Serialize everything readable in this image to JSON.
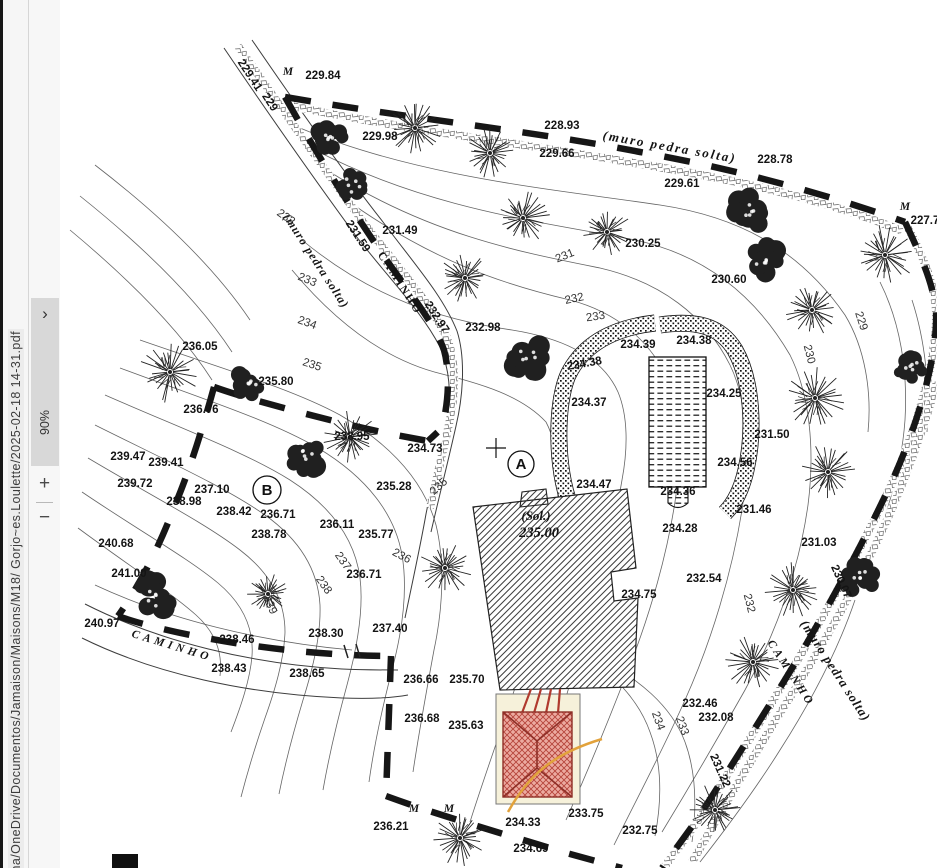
{
  "sidebar": {
    "file_path": "ma/OneDrive/Documentos/Jamaison/Maisons/M18/ Gorjo~es.Loulette/2025-02-18 14-31.pdf",
    "expand_chevron": "›",
    "zoom_level": "90%",
    "zoom_in": "+",
    "zoom_out": "−"
  },
  "map": {
    "site_label": "(Sol.)",
    "site_elevation": "235.00",
    "markers": [
      {
        "label": "A",
        "x": 521,
        "y": 464,
        "r": 13
      },
      {
        "label": "B",
        "x": 267,
        "y": 490,
        "r": 14
      }
    ],
    "labels": [
      {
        "t": "229.41",
        "x": 247,
        "y": 77,
        "r": 57
      },
      {
        "t": "229",
        "x": 267,
        "y": 104,
        "r": 57
      },
      {
        "t": "M",
        "x": 288,
        "y": 75,
        "i": 1,
        "f": "serif"
      },
      {
        "t": "229.84",
        "x": 323,
        "y": 79
      },
      {
        "t": "229.98",
        "x": 380,
        "y": 140
      },
      {
        "t": "228.93",
        "x": 562,
        "y": 129
      },
      {
        "t": "(muro pedra solta)",
        "x": 669,
        "y": 151,
        "r": 10,
        "i": 1,
        "f": "serif",
        "s": 13,
        "sp": 2
      },
      {
        "t": "229.66",
        "x": 557,
        "y": 157
      },
      {
        "t": "229.61",
        "x": 682,
        "y": 187
      },
      {
        "t": "228.78",
        "x": 775,
        "y": 163
      },
      {
        "t": "M",
        "x": 905,
        "y": 210,
        "i": 1,
        "f": "serif"
      },
      {
        "t": "227.7",
        "x": 925,
        "y": 224
      },
      {
        "t": "231.49",
        "x": 400,
        "y": 234
      },
      {
        "t": "230.25",
        "x": 643,
        "y": 247
      },
      {
        "t": "231",
        "x": 566,
        "y": 259,
        "r": -22,
        "c": "#333",
        "w": 400
      },
      {
        "t": "230.60",
        "x": 729,
        "y": 283
      },
      {
        "t": "229",
        "x": 858,
        "y": 322,
        "r": 72,
        "c": "#333",
        "w": 400
      },
      {
        "t": "230",
        "x": 806,
        "y": 355,
        "r": 76,
        "c": "#333",
        "w": 400
      },
      {
        "t": "(muro pedra solta)",
        "x": 313,
        "y": 263,
        "r": 57,
        "i": 1,
        "f": "serif",
        "s": 12,
        "sp": 1
      },
      {
        "t": "231.59",
        "x": 355,
        "y": 238,
        "r": 57
      },
      {
        "t": "CAMINHO",
        "x": 397,
        "y": 285,
        "r": 57,
        "f": "serif",
        "sp": 2
      },
      {
        "t": "232.97",
        "x": 434,
        "y": 319,
        "r": 57
      },
      {
        "t": "232",
        "x": 284,
        "y": 220,
        "r": 35,
        "c": "#333",
        "w": 400
      },
      {
        "t": "233",
        "x": 306,
        "y": 283,
        "r": 22,
        "c": "#333",
        "w": 400
      },
      {
        "t": "234",
        "x": 306,
        "y": 326,
        "r": 20,
        "c": "#333",
        "w": 400
      },
      {
        "t": "235",
        "x": 311,
        "y": 368,
        "r": 18,
        "c": "#333",
        "w": 400
      },
      {
        "t": "232",
        "x": 575,
        "y": 302,
        "r": -12,
        "c": "#333",
        "w": 400
      },
      {
        "t": "233",
        "x": 596,
        "y": 320,
        "r": -8,
        "c": "#333",
        "w": 400
      },
      {
        "t": "232.98",
        "x": 483,
        "y": 331
      },
      {
        "t": "236.05",
        "x": 200,
        "y": 350
      },
      {
        "t": "235.80",
        "x": 276,
        "y": 385
      },
      {
        "t": "236.76",
        "x": 201,
        "y": 413
      },
      {
        "t": "238.95",
        "x": 352,
        "y": 440
      },
      {
        "t": "234.73",
        "x": 425,
        "y": 452
      },
      {
        "t": "235.28",
        "x": 394,
        "y": 490
      },
      {
        "t": "235",
        "x": 441,
        "y": 489,
        "r": -42,
        "c": "#333",
        "w": 400
      },
      {
        "t": "239.47",
        "x": 128,
        "y": 460
      },
      {
        "t": "239.41",
        "x": 166,
        "y": 466
      },
      {
        "t": "239.72",
        "x": 135,
        "y": 487
      },
      {
        "t": "237.10",
        "x": 212,
        "y": 493
      },
      {
        "t": "238.98",
        "x": 184,
        "y": 505
      },
      {
        "t": "238.42",
        "x": 234,
        "y": 515
      },
      {
        "t": "236.71",
        "x": 278,
        "y": 518
      },
      {
        "t": "238.78",
        "x": 269,
        "y": 538
      },
      {
        "t": "236.11",
        "x": 337,
        "y": 528
      },
      {
        "t": "235.77",
        "x": 376,
        "y": 538
      },
      {
        "t": "236.71",
        "x": 364,
        "y": 578
      },
      {
        "t": "236",
        "x": 400,
        "y": 559,
        "r": 28,
        "c": "#333",
        "w": 400
      },
      {
        "t": "237",
        "x": 340,
        "y": 563,
        "r": 55,
        "c": "#333",
        "w": 400
      },
      {
        "t": "238",
        "x": 321,
        "y": 587,
        "r": 55,
        "c": "#333",
        "w": 400
      },
      {
        "t": "240.68",
        "x": 116,
        "y": 547
      },
      {
        "t": "241.00",
        "x": 129,
        "y": 577
      },
      {
        "t": "240.97",
        "x": 102,
        "y": 627
      },
      {
        "t": "CAMINHO",
        "x": 171,
        "y": 649,
        "r": 17,
        "i": 1,
        "f": "serif",
        "sp": 4
      },
      {
        "t": "238.46",
        "x": 237,
        "y": 643
      },
      {
        "t": "238.30",
        "x": 326,
        "y": 637
      },
      {
        "t": "237.40",
        "x": 390,
        "y": 632
      },
      {
        "t": "238.43",
        "x": 229,
        "y": 672
      },
      {
        "t": "238.65",
        "x": 307,
        "y": 677
      },
      {
        "t": "239",
        "x": 267,
        "y": 606,
        "r": 68,
        "c": "#333",
        "w": 400
      },
      {
        "t": "236.66",
        "x": 421,
        "y": 683
      },
      {
        "t": "235.70",
        "x": 467,
        "y": 683
      },
      {
        "t": "236.68",
        "x": 422,
        "y": 722
      },
      {
        "t": "235.63",
        "x": 466,
        "y": 729
      },
      {
        "t": "(Sol.)",
        "x": 536,
        "y": 520,
        "i": 1,
        "f": "serif",
        "s": 13
      },
      {
        "t": "235.00",
        "x": 539,
        "y": 537,
        "i": 1,
        "f": "serif",
        "s": 14.5
      },
      {
        "t": "234.39",
        "x": 638,
        "y": 348
      },
      {
        "t": "234.38",
        "x": 694,
        "y": 344
      },
      {
        "t": "234.38",
        "x": 585,
        "y": 367,
        "r": -10
      },
      {
        "t": "234.37",
        "x": 589,
        "y": 406
      },
      {
        "t": "234.47",
        "x": 594,
        "y": 488
      },
      {
        "t": "234.36",
        "x": 678,
        "y": 495
      },
      {
        "t": "234.28",
        "x": 680,
        "y": 532
      },
      {
        "t": "234.25",
        "x": 724,
        "y": 397
      },
      {
        "t": "231.50",
        "x": 772,
        "y": 438
      },
      {
        "t": "234.56",
        "x": 735,
        "y": 466
      },
      {
        "t": "231.46",
        "x": 754,
        "y": 513
      },
      {
        "t": "231.03",
        "x": 819,
        "y": 546
      },
      {
        "t": "234.75",
        "x": 639,
        "y": 598
      },
      {
        "t": "232.54",
        "x": 704,
        "y": 582
      },
      {
        "t": "232",
        "x": 746,
        "y": 604,
        "r": 76,
        "c": "#333",
        "w": 400
      },
      {
        "t": "232.46",
        "x": 700,
        "y": 707
      },
      {
        "t": "232.08",
        "x": 716,
        "y": 721
      },
      {
        "t": "234",
        "x": 655,
        "y": 722,
        "r": 70,
        "c": "#333",
        "w": 400
      },
      {
        "t": "233",
        "x": 679,
        "y": 727,
        "r": 70,
        "c": "#333",
        "w": 400
      },
      {
        "t": "230.07",
        "x": 838,
        "y": 583,
        "r": 66
      },
      {
        "t": "CAMINHO",
        "x": 788,
        "y": 675,
        "r": 57,
        "i": 1,
        "f": "serif",
        "sp": 3
      },
      {
        "t": "(muro pedra solta)",
        "x": 832,
        "y": 673,
        "r": 57,
        "i": 1,
        "f": "serif",
        "s": 13,
        "sp": 1
      },
      {
        "t": "231.22",
        "x": 717,
        "y": 772,
        "r": 66
      },
      {
        "t": "236.21",
        "x": 391,
        "y": 830
      },
      {
        "t": "M",
        "x": 414,
        "y": 812,
        "i": 1,
        "f": "serif"
      },
      {
        "t": "M",
        "x": 449,
        "y": 812,
        "i": 1,
        "f": "serif"
      },
      {
        "t": "234.33",
        "x": 523,
        "y": 826
      },
      {
        "t": "234.69",
        "x": 531,
        "y": 852
      },
      {
        "t": "233.75",
        "x": 586,
        "y": 817
      },
      {
        "t": "232.75",
        "x": 640,
        "y": 834
      }
    ],
    "colors": {
      "ink": "#161616",
      "contour": "#4a4a4a",
      "roof_red": "#b5443b",
      "roof_fill": "#ecaaa0",
      "plot_cream": "#f6f1da",
      "path_orange": "#e2a23b"
    }
  }
}
